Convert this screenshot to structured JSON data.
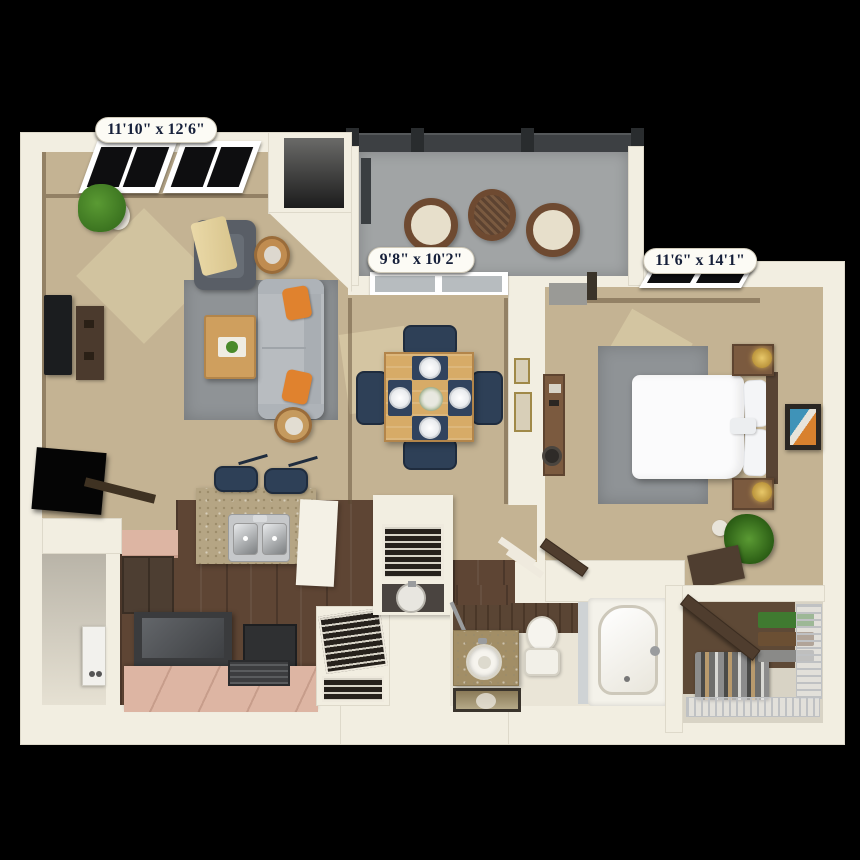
{
  "page": {
    "description": "3D rendered one-bedroom apartment floor plan, top-down view on black background"
  },
  "labels": {
    "living_room_dims": "11'10\" x 12'6\"",
    "dining_dims": "9'8\" x 10'2\"",
    "bedroom_dims": "11'6\" x 14'1\""
  },
  "rooms": [
    {
      "id": "living-room",
      "dimensions": "11'10\" x 12'6\""
    },
    {
      "id": "dining-area",
      "dimensions": "9'8\" x 10'2\""
    },
    {
      "id": "bedroom",
      "dimensions": "11'6\" x 14'1\""
    },
    {
      "id": "kitchen"
    },
    {
      "id": "bathroom"
    },
    {
      "id": "balcony"
    },
    {
      "id": "walk-in-closet"
    },
    {
      "id": "entry"
    }
  ],
  "palette": {
    "bg": "#000000",
    "wall": "#f2eee1",
    "carpet": "#c4b393",
    "carpetLight": "#ddd0aa",
    "rug": "#8f9396",
    "sofa": "#b8bcc0",
    "sofaDark": "#a9aeb3",
    "chairDark": "#595e66",
    "throw": "#ead9a8",
    "orange": "#e0822e",
    "woodTable": "#d7ab67",
    "woodTableDark": "#b3854a",
    "sideTable": "#c08c50",
    "tv": "#1b1d1f",
    "console": "#4b3a2d",
    "railing": "#3d4043",
    "post": "#292c2e",
    "concrete": "#a1a4a5",
    "wicker": "#6e4a31",
    "cushion": "#e7dfcb",
    "glass": "#b7bcbf",
    "windowDark": "#0e0e10",
    "navy": "#2e4057",
    "navyDark": "#1f2c3e",
    "granite": "#b5a584",
    "graniteDark": "#9c8c6a",
    "counterWhite": "#f4f1e6",
    "steel": "#c6c8ca",
    "pink": "#ddb5a3",
    "pinkDark": "#c79d8b",
    "woodFloor": "#5e4534",
    "cabinet": "#4d3e32",
    "range": "#3a3b3d",
    "bathFloor": "#eae5d7",
    "panelWood": "#5a4534",
    "vanity": "#a28e66",
    "fixtureWhite": "#f6f4ee",
    "fixtureEdge": "#cdc8ba",
    "closetFloor": "#5e4936",
    "closetBase": "#d8d3c5",
    "wire": "#bfc1c3",
    "louver": "#26211c",
    "louverLine": "#d8d4c8",
    "doorBrown": "#4f3d2e",
    "headboard": "#584434",
    "nightstand": "#7b5a3f",
    "lampGold": "#c9a244",
    "green": "#4a8a2a",
    "greenDark": "#2f6418",
    "potWhite": "#e8e4da",
    "artTeal": "#3f93b8",
    "artOrange": "#d8812e",
    "pillBg": "#fcfbf5",
    "pillText": "#16203a",
    "pillBorder": "#cfc9b8"
  }
}
